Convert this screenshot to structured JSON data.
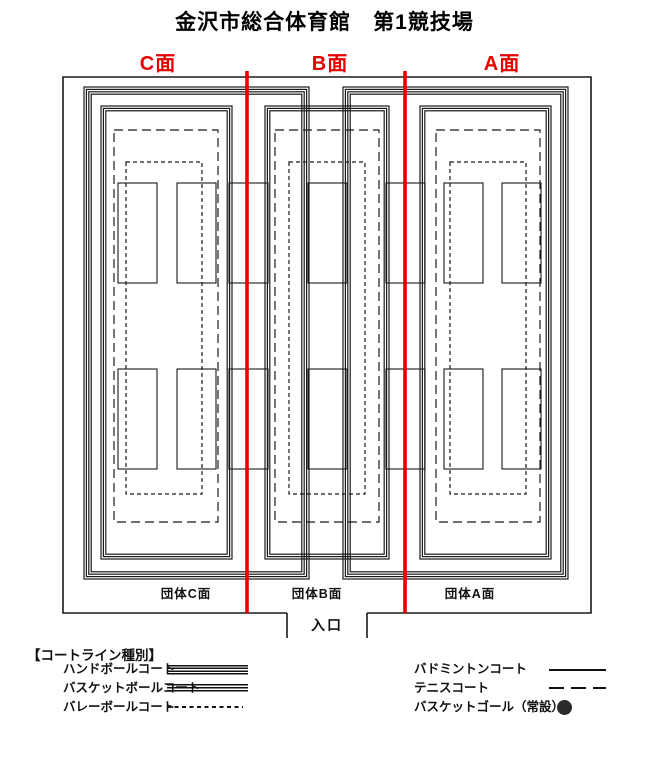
{
  "title": "金沢市総合体育館　第1競技場",
  "colors": {
    "divider_red": "#e60000",
    "court_line_black": "#1a1a1a",
    "goal_dot": "#2b2b2b"
  },
  "faces": [
    {
      "label": "C面"
    },
    {
      "label": "B面"
    },
    {
      "label": "A面"
    }
  ],
  "group_faces": [
    {
      "label": "団体C面"
    },
    {
      "label": "団体B面"
    },
    {
      "label": "団体A面"
    }
  ],
  "entrance_label": "入口",
  "legend": {
    "header": "【コートライン種別】",
    "left_items": [
      {
        "label": "ハンドボールコート",
        "style": "quadruple-solid-line"
      },
      {
        "label": "バスケットボールコート",
        "style": "triple-solid-line"
      },
      {
        "label": "バレーボールコート",
        "style": "fine-dashed-line"
      }
    ],
    "right_items": [
      {
        "label": "バドミントンコート",
        "style": "thin-solid-line"
      },
      {
        "label": "テニスコート",
        "style": "long-dashed-line"
      },
      {
        "label": "バスケットゴール（常設）",
        "style": "filled-dot"
      }
    ]
  }
}
